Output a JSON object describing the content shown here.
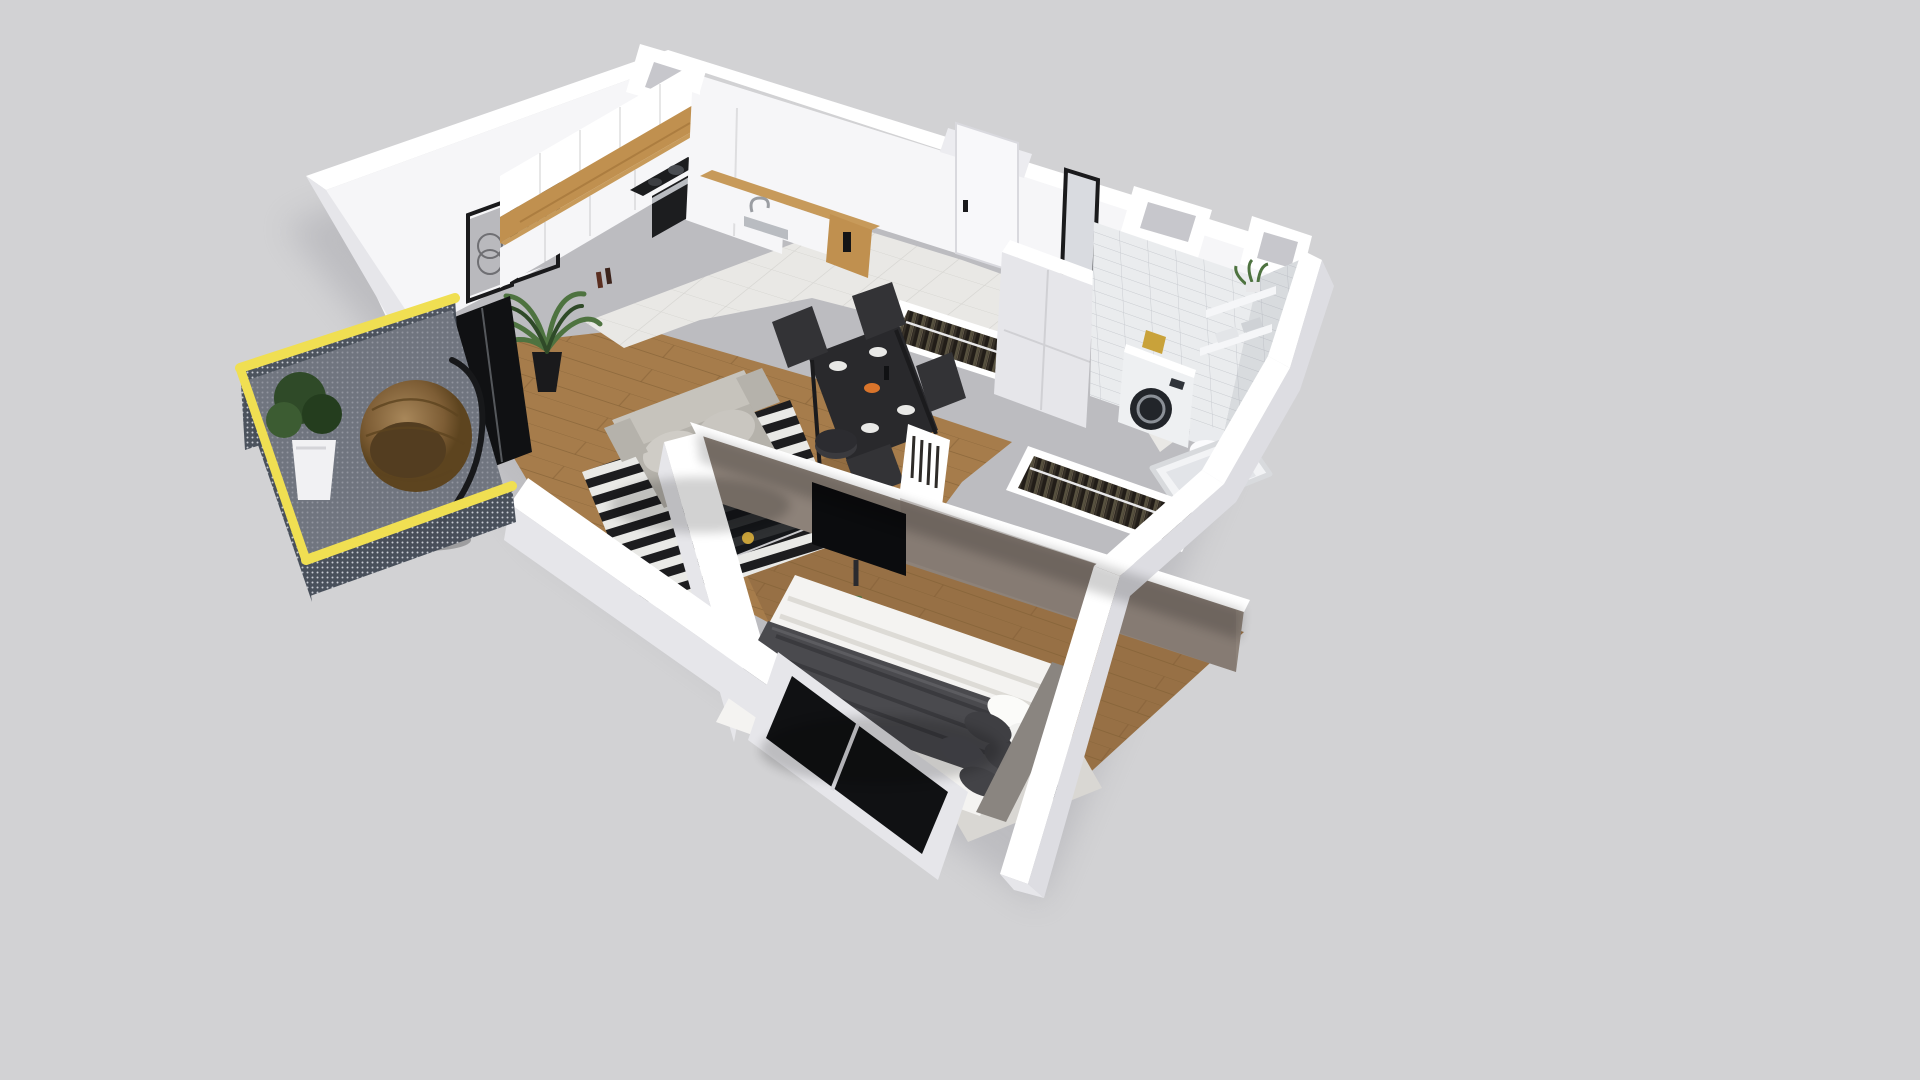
{
  "meta": {
    "view": "isometric-cutaway-apartment-floorplan",
    "width": 1920,
    "height": 1080
  },
  "palette": {
    "bg": "#d2d2d4",
    "shadow": "#a3a3a9",
    "wallFace": "#f6f6f8",
    "wallTop": "#ffffff",
    "wallSide": "#e6e6ea",
    "wallRecess": "#ececf0",
    "wallDim": "#dddde2",
    "taupe": "#8d8279",
    "taupeDark": "#7c7169",
    "tile": "#e9e8e5",
    "tileLine": "#d6d5d1",
    "woodAccent": "#c0904f",
    "counterWood": "#c79a5a",
    "floorWood": "#a67c4b",
    "plankLine": "#7e5c33",
    "bedroomWood": "#977045",
    "bathTileBase": "#eaecee",
    "grout": "#c7cacf",
    "glassDark": "#101113",
    "tv": "#0b0c0e",
    "sofaBase": "#b5b2ab",
    "sofaCushion": "#c6c3bc",
    "dining": "#29292c",
    "chair": "#333336",
    "rugBlack": "#1d1d1f",
    "rugWhite": "#e9e9e6",
    "railYellow": "#f0df52",
    "mesh": "#454c57",
    "meshDot": "#dfe3e9",
    "balconyFloor": "#7e838c",
    "rattanLight": "#9a7a4e",
    "rattanDark": "#6e522f",
    "rattanRim": "#533d20",
    "potWhite": "#f1f1f3",
    "leafDark": "#2f4a28",
    "leafLight": "#4e7340",
    "steel": "#b9bcc1",
    "clothesBg": "#221d18",
    "clothesA": "#57513f",
    "clothesB": "#39332a",
    "duvetDark": "#4a4a4e",
    "linenWhite": "#f4f3f1",
    "pillowDark": "#3f3f43",
    "lampBlack": "#17181a",
    "benchGray": "#b6b2ad",
    "doorWhite": "#f8f8fa",
    "frameBlack": "#1a1a1c",
    "artGray": "#b9b9bd",
    "bookDark": "#2e2b28",
    "towelWhite": "#f5f6f8",
    "brassGold": "#c9a23a",
    "orange": "#d9742b",
    "carpetGray": "#d9d7d3",
    "headboardGray": "#8a8580",
    "ovenDark": "#1c1d1f",
    "applianceWhite": "#eef0f2",
    "washerDoor": "#22252a"
  },
  "scene": {
    "rooms": [
      {
        "name": "kitchen"
      },
      {
        "name": "living-dining"
      },
      {
        "name": "hallway"
      },
      {
        "name": "bathroom"
      },
      {
        "name": "bedroom"
      },
      {
        "name": "balcony"
      }
    ],
    "furniture": [
      "kitchen-cabinets",
      "cooktop",
      "oven",
      "sink",
      "wall-art",
      "palm-plant",
      "dining-table",
      "dining-chairs",
      "sofa",
      "striped-rug",
      "coffee-table",
      "tv",
      "entry-door",
      "mirror",
      "bench",
      "coat-rack",
      "tall-wardrobe",
      "washing-machine",
      "toilet",
      "bathtub",
      "bath-shelves",
      "bed",
      "pillows",
      "night-lamp",
      "closet-rack",
      "window-wall",
      "hanging-egg-chair",
      "planter"
    ]
  }
}
